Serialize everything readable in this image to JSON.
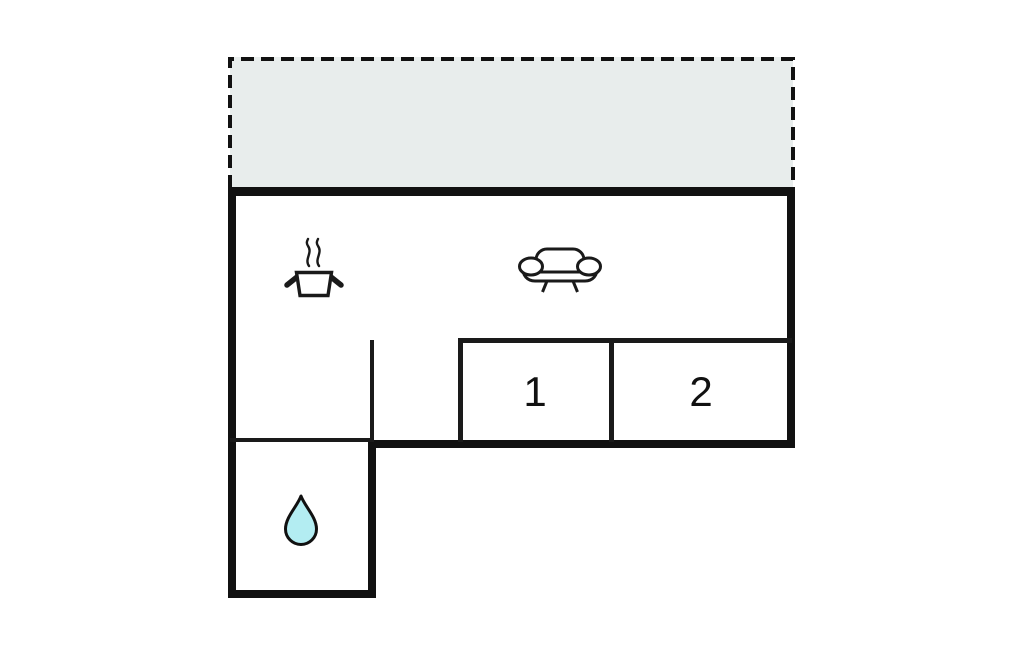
{
  "plan": {
    "type": "floor-plan",
    "room1_label": "1",
    "room2_label": "2"
  },
  "colors": {
    "background": "#ffffff",
    "wall": "#111111",
    "thin_wall": "#1a1a1a",
    "terrace_fill": "#e8edec",
    "terrace_stroke": "#111111",
    "drop_fill": "#b3edf2",
    "icon_stroke": "#1a1a1a",
    "label_color": "#111111"
  },
  "areas": [
    {
      "name": "terrace",
      "style": "dashed-outline",
      "icons": []
    },
    {
      "name": "living-kitchen-area",
      "icons": [
        "cooking-pot-icon",
        "sofa-icon"
      ]
    },
    {
      "name": "room-1",
      "label": "1"
    },
    {
      "name": "room-2",
      "label": "2"
    },
    {
      "name": "bathroom",
      "icons": [
        "water-drop-icon"
      ]
    }
  ],
  "icons": [
    {
      "name": "cooking-pot-icon",
      "meaning": "kitchen"
    },
    {
      "name": "sofa-icon",
      "meaning": "living room"
    },
    {
      "name": "water-drop-icon",
      "meaning": "bathroom"
    }
  ]
}
